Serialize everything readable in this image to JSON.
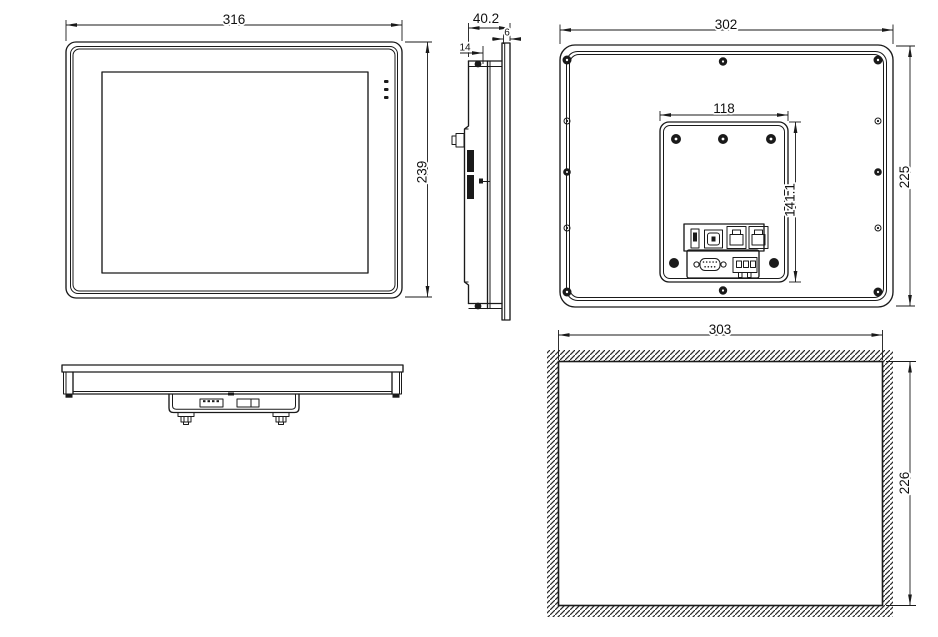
{
  "drawing": {
    "type": "technical-dimension-drawing",
    "views": {
      "front": {
        "name": "front-view",
        "width": "316",
        "height": "239"
      },
      "side": {
        "name": "side-view",
        "overall_depth": "40.2",
        "rear_depth": "14",
        "bezel_thickness": "6"
      },
      "back": {
        "name": "back-view",
        "width": "302",
        "height": "225",
        "mounting_module_width": "118",
        "mounting_module_height": "141.1"
      },
      "bottom": {
        "name": "bottom-view"
      },
      "cutout": {
        "name": "panel-cutout-view",
        "width": "303",
        "height": "226"
      }
    },
    "colors": {
      "line": "#1a1a1a",
      "background": "#ffffff",
      "hatch": "#2a2a2a"
    }
  }
}
